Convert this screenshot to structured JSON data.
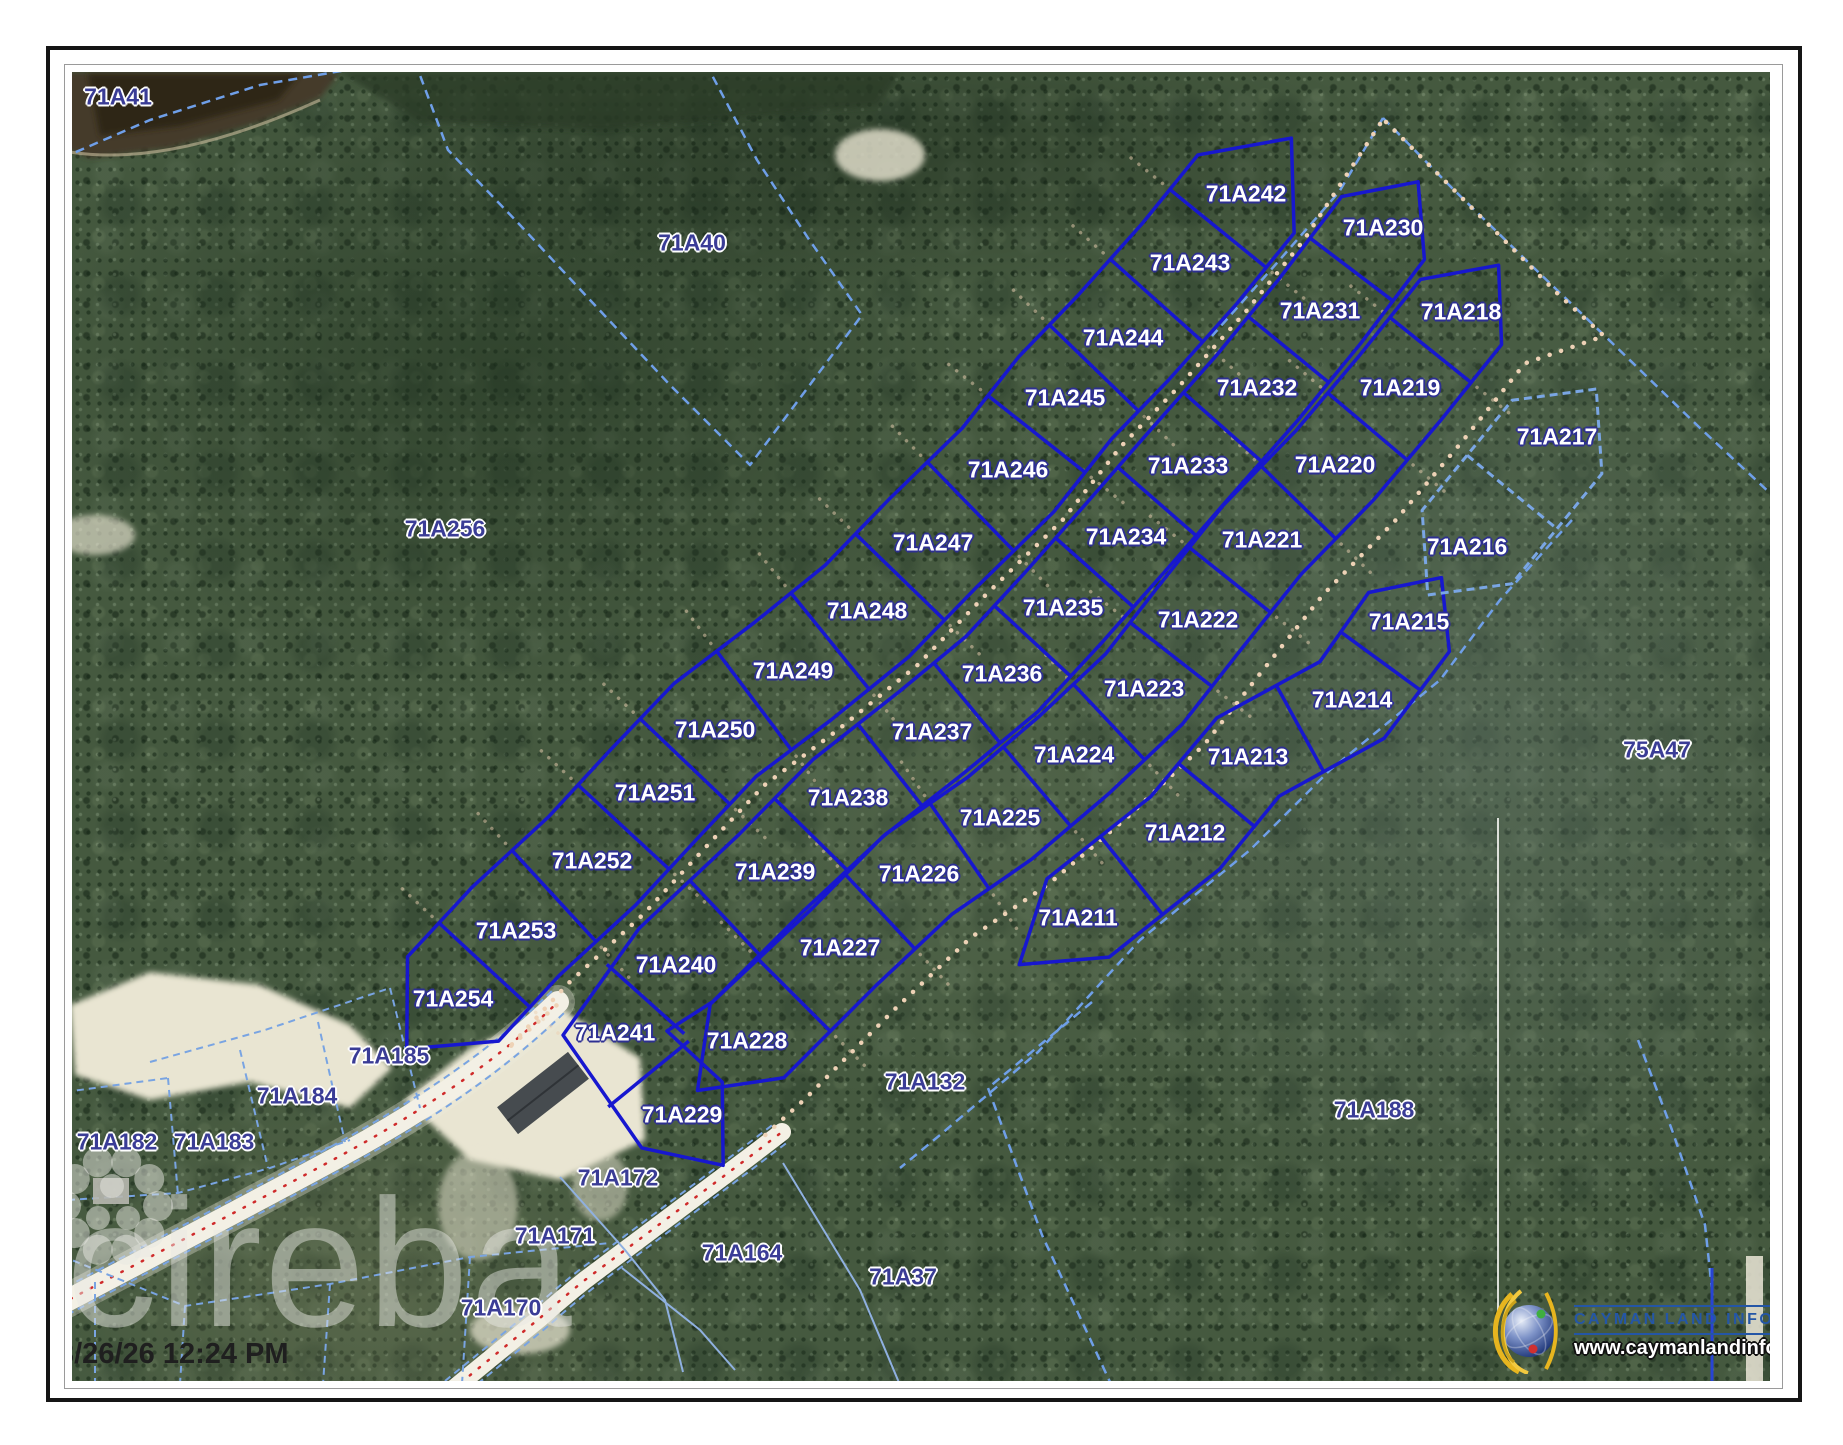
{
  "map": {
    "watermark_text": "cireba",
    "timestamp": "3/26/26 12:24 PM",
    "logo": {
      "title": "CAYMAN LAND INFO",
      "url": "www.caymanlandinfo.ky"
    },
    "colors": {
      "lot_border": "#1717cf",
      "boundary_dashed": "#6f9fe8",
      "label_white": "#ffffff",
      "label_blue": "#3a3c96",
      "track_dots": "#eed2b6",
      "road_centerline": "#cf2b2b",
      "logo_blue": "#2456a6"
    },
    "parcels": [
      {
        "id": "71A41",
        "x": 118,
        "y": 97,
        "style": "blue"
      },
      {
        "id": "71A40",
        "x": 692,
        "y": 243,
        "style": "blue"
      },
      {
        "id": "71A256",
        "x": 445,
        "y": 529,
        "style": "blue"
      },
      {
        "id": "75A47",
        "x": 1657,
        "y": 750,
        "style": "blue"
      },
      {
        "id": "71A185",
        "x": 389,
        "y": 1056,
        "style": "blue"
      },
      {
        "id": "71A184",
        "x": 297,
        "y": 1096,
        "style": "blue"
      },
      {
        "id": "71A183",
        "x": 214,
        "y": 1142,
        "style": "blue"
      },
      {
        "id": "71A182",
        "x": 117,
        "y": 1142,
        "style": "blue"
      },
      {
        "id": "71A132",
        "x": 925,
        "y": 1082,
        "style": "blue"
      },
      {
        "id": "71A188",
        "x": 1374,
        "y": 1110,
        "style": "blue"
      },
      {
        "id": "71A172",
        "x": 618,
        "y": 1178,
        "style": "blue"
      },
      {
        "id": "71A171",
        "x": 555,
        "y": 1236,
        "style": "blue"
      },
      {
        "id": "71A170",
        "x": 501,
        "y": 1308,
        "style": "blue"
      },
      {
        "id": "71A164",
        "x": 742,
        "y": 1253,
        "style": "blue"
      },
      {
        "id": "71A37",
        "x": 903,
        "y": 1277,
        "style": "blue"
      },
      {
        "id": "71A242",
        "x": 1246,
        "y": 194,
        "style": "white"
      },
      {
        "id": "71A243",
        "x": 1190,
        "y": 263,
        "style": "white"
      },
      {
        "id": "71A244",
        "x": 1123,
        "y": 338,
        "style": "white"
      },
      {
        "id": "71A245",
        "x": 1065,
        "y": 398,
        "style": "white"
      },
      {
        "id": "71A246",
        "x": 1008,
        "y": 470,
        "style": "white"
      },
      {
        "id": "71A247",
        "x": 933,
        "y": 543,
        "style": "white"
      },
      {
        "id": "71A248",
        "x": 867,
        "y": 611,
        "style": "white"
      },
      {
        "id": "71A249",
        "x": 793,
        "y": 671,
        "style": "white"
      },
      {
        "id": "71A250",
        "x": 715,
        "y": 730,
        "style": "white"
      },
      {
        "id": "71A251",
        "x": 655,
        "y": 793,
        "style": "white"
      },
      {
        "id": "71A252",
        "x": 592,
        "y": 861,
        "style": "white"
      },
      {
        "id": "71A253",
        "x": 516,
        "y": 931,
        "style": "white"
      },
      {
        "id": "71A254",
        "x": 453,
        "y": 999,
        "style": "white"
      },
      {
        "id": "71A230",
        "x": 1383,
        "y": 228,
        "style": "white"
      },
      {
        "id": "71A231",
        "x": 1320,
        "y": 311,
        "style": "white"
      },
      {
        "id": "71A232",
        "x": 1257,
        "y": 388,
        "style": "white"
      },
      {
        "id": "71A233",
        "x": 1188,
        "y": 466,
        "style": "white"
      },
      {
        "id": "71A234",
        "x": 1126,
        "y": 537,
        "style": "white"
      },
      {
        "id": "71A235",
        "x": 1063,
        "y": 608,
        "style": "white"
      },
      {
        "id": "71A236",
        "x": 1002,
        "y": 674,
        "style": "white"
      },
      {
        "id": "71A237",
        "x": 932,
        "y": 732,
        "style": "white"
      },
      {
        "id": "71A238",
        "x": 848,
        "y": 798,
        "style": "white"
      },
      {
        "id": "71A239",
        "x": 775,
        "y": 872,
        "style": "white"
      },
      {
        "id": "71A240",
        "x": 676,
        "y": 965,
        "style": "white"
      },
      {
        "id": "71A241",
        "x": 615,
        "y": 1033,
        "style": "white"
      },
      {
        "id": "71A229",
        "x": 682,
        "y": 1115,
        "style": "white"
      },
      {
        "id": "71A218",
        "x": 1461,
        "y": 312,
        "style": "white"
      },
      {
        "id": "71A219",
        "x": 1400,
        "y": 388,
        "style": "white"
      },
      {
        "id": "71A220",
        "x": 1335,
        "y": 465,
        "style": "white"
      },
      {
        "id": "71A221",
        "x": 1262,
        "y": 540,
        "style": "white"
      },
      {
        "id": "71A222",
        "x": 1198,
        "y": 620,
        "style": "white"
      },
      {
        "id": "71A223",
        "x": 1144,
        "y": 689,
        "style": "white"
      },
      {
        "id": "71A224",
        "x": 1074,
        "y": 755,
        "style": "white"
      },
      {
        "id": "71A225",
        "x": 1000,
        "y": 818,
        "style": "white"
      },
      {
        "id": "71A226",
        "x": 919,
        "y": 874,
        "style": "white"
      },
      {
        "id": "71A227",
        "x": 840,
        "y": 948,
        "style": "white"
      },
      {
        "id": "71A228",
        "x": 747,
        "y": 1041,
        "style": "white"
      },
      {
        "id": "71A215",
        "x": 1409,
        "y": 622,
        "style": "white"
      },
      {
        "id": "71A214",
        "x": 1352,
        "y": 700,
        "style": "white"
      },
      {
        "id": "71A213",
        "x": 1248,
        "y": 757,
        "style": "white"
      },
      {
        "id": "71A212",
        "x": 1185,
        "y": 833,
        "style": "white"
      },
      {
        "id": "71A211",
        "x": 1078,
        "y": 918,
        "style": "white"
      },
      {
        "id": "71A217",
        "x": 1557,
        "y": 437,
        "style": "white"
      },
      {
        "id": "71A216",
        "x": 1467,
        "y": 547,
        "style": "white"
      }
    ],
    "columns": {
      "west": [
        "71A242",
        "71A243",
        "71A244",
        "71A245",
        "71A246",
        "71A247",
        "71A248",
        "71A249",
        "71A250",
        "71A251",
        "71A252",
        "71A253",
        "71A254"
      ],
      "middle": [
        "71A230",
        "71A231",
        "71A232",
        "71A233",
        "71A234",
        "71A235",
        "71A236",
        "71A237",
        "71A238",
        "71A239",
        "71A240",
        "71A241",
        "71A229"
      ],
      "east": [
        "71A218",
        "71A219",
        "71A220",
        "71A221",
        "71A222",
        "71A223",
        "71A224",
        "71A225",
        "71A226",
        "71A227",
        "71A228"
      ],
      "far_east": [
        "71A215",
        "71A214",
        "71A213",
        "71A212",
        "71A211"
      ],
      "far_east_unhighlighted": [
        "71A217",
        "71A216"
      ]
    }
  }
}
